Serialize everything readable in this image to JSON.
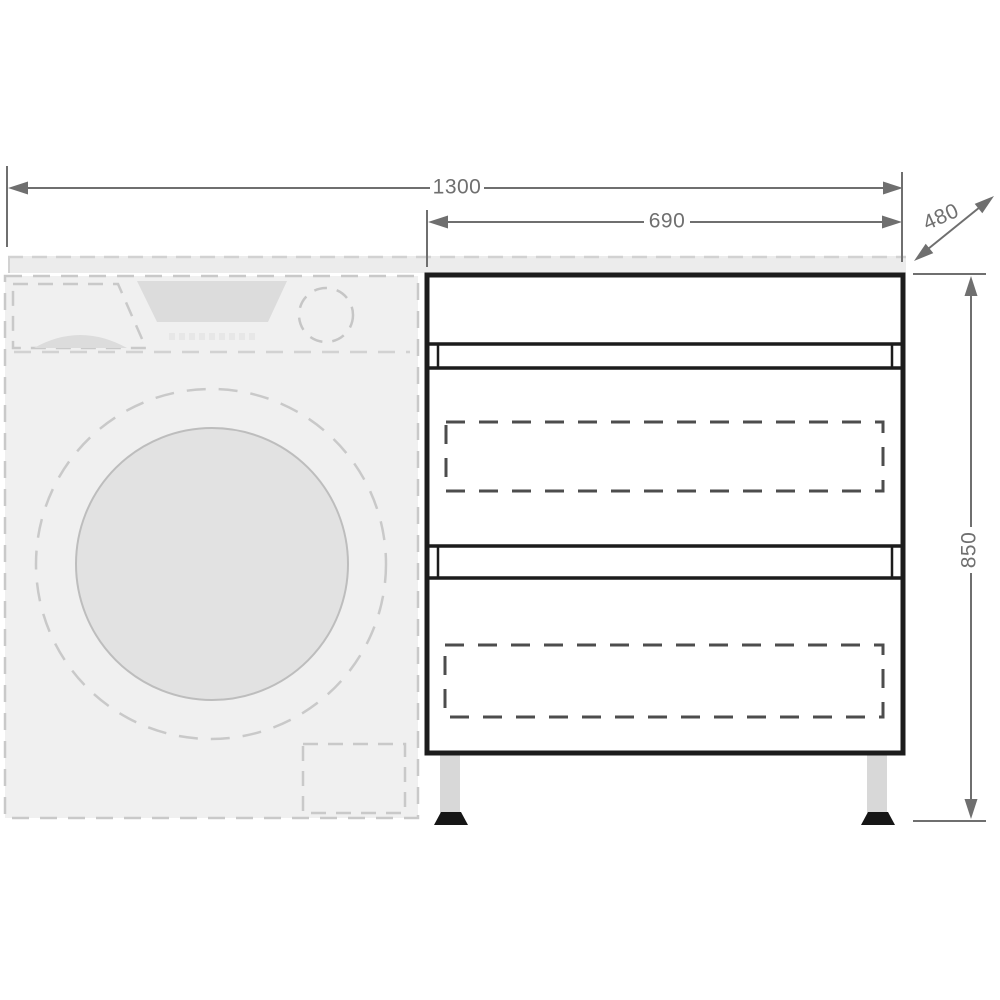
{
  "diagram": {
    "kind": "furniture-dimension-drawing",
    "dimensions": {
      "total_width": "1300",
      "cabinet_width": "690",
      "depth": "480",
      "cabinet_height": "850"
    },
    "colors": {
      "background": "#ffffff",
      "dimension_gray": "#6f6f6f",
      "cabinet_line": "#1c1c1c",
      "washer_fill": "#f0f0f0",
      "washer_dash": "#c9c9c9",
      "countertop_fill": "#ececec",
      "drum_fill": "#e2e2e2",
      "display_fill": "#dcdcdc",
      "drawer_dash": "#4d4d4d",
      "leg_fill": "#d8d8d8",
      "foot_fill": "#161616"
    }
  }
}
